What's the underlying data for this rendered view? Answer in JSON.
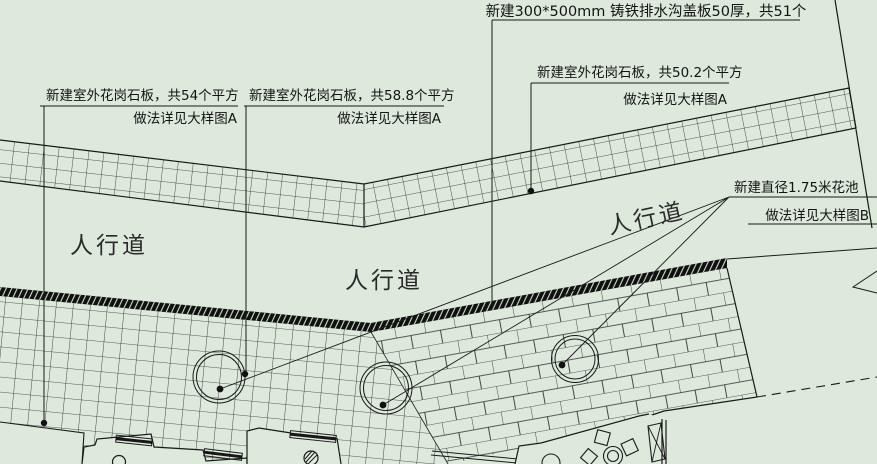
{
  "drawing_type": "site-plan-cad",
  "colors": {
    "background": "#dce9db",
    "line": "#1a1a1a",
    "hatch": "#2b2b2b",
    "dark_band": "#101010"
  },
  "annotations": {
    "drain": {
      "line1": "新建300*500mm 铸铁排水沟盖板50厚，共51个"
    },
    "granite54": {
      "line1": "新建室外花岗石板，共54个平方",
      "line2": "做法详见大样图A"
    },
    "granite588": {
      "line1": "新建室外花岗石板，共58.8个平方",
      "line2": "做法详见大样图A"
    },
    "granite502": {
      "line1": "新建室外花岗石板，共50.2个平方",
      "line2": "做法详见大样图A"
    },
    "flowerbed": {
      "line1": "新建直径1.75米花池",
      "line2": "做法详见大样图B"
    }
  },
  "labels": {
    "sidewalk1": "人行道",
    "sidewalk2": "人行道",
    "sidewalk3": "人行道"
  }
}
